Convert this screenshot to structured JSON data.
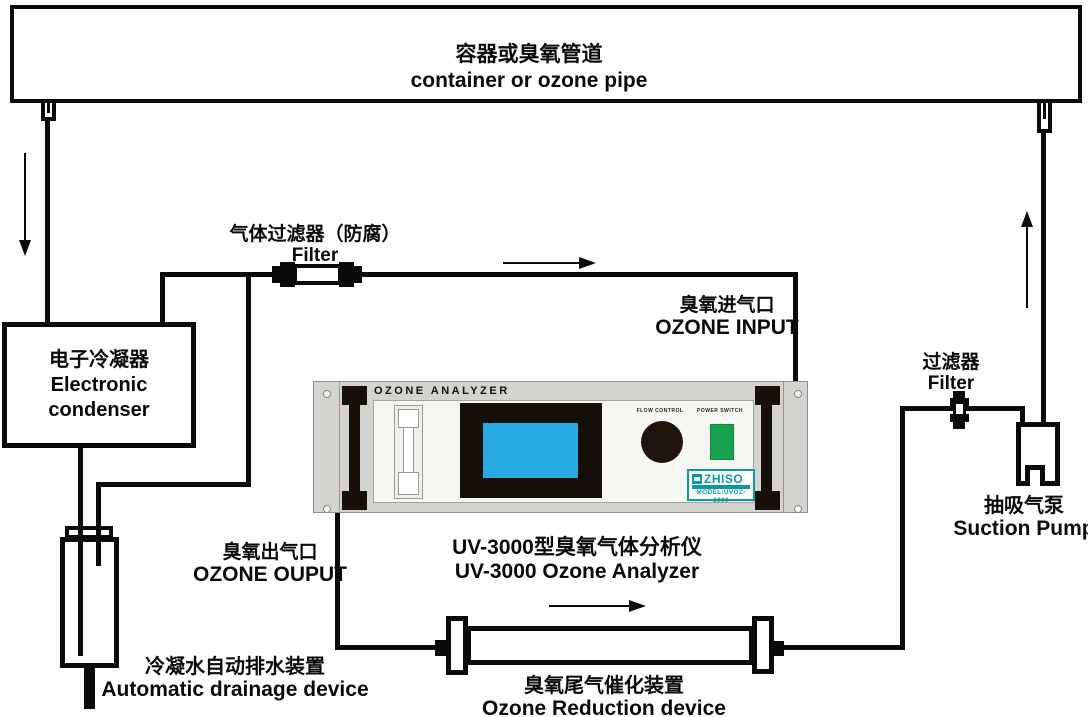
{
  "labels": {
    "container_pipe": {
      "zh": "容器或臭氧管道",
      "en": "container or ozone pipe"
    },
    "condenser": {
      "zh": "电子冷凝器",
      "en": "Electronic condenser"
    },
    "gas_filter": {
      "zh": "气体过滤器（防腐）",
      "en": "Filter"
    },
    "ozone_input": {
      "zh": "臭氧进气口",
      "en": "OZONE INPUT"
    },
    "ozone_output": {
      "zh": "臭氧出气口",
      "en": "OZONE OUPUT"
    },
    "analyzer_caption": {
      "zh": "UV-3000型臭氧气体分析仪",
      "en": "UV-3000 Ozone Analyzer"
    },
    "drainage_device": {
      "zh": "冷凝水自动排水装置",
      "en": "Automatic drainage device"
    },
    "reduction_device": {
      "zh": "臭氧尾气催化装置",
      "en": "Ozone Reduction device"
    },
    "right_filter": {
      "zh": "过滤器",
      "en": "Filter"
    },
    "suction_pump": {
      "zh": "抽吸气泵",
      "en": "Suction Pump"
    }
  },
  "analyzer": {
    "title": "OZONE ANALYZER",
    "flow_control_label": "FLOW CONTROL",
    "power_switch_label": "POWER SWITCH",
    "brand": "ZHISO",
    "model": "MODEL:UVOZ-3000"
  },
  "colors": {
    "line_black": "#0a0a0a",
    "analyzer_body_gray": "#d3d3cf",
    "analyzer_panel_gray": "#f6f6f3",
    "display_bezel_black": "#150f0a",
    "screen_blue": "#29a9e1",
    "knob_black": "#1f150d",
    "power_switch_green": "#18a24b",
    "brand_teal": "#0e98a2"
  }
}
